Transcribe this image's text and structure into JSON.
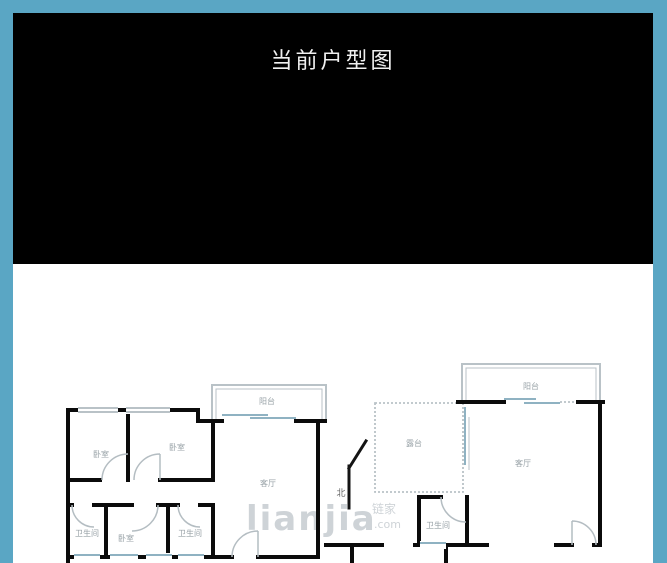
{
  "frame": {
    "border_color": "#5aa6c4",
    "header_bg": "#000000",
    "content_bg": "#ffffff"
  },
  "header": {
    "title": "当前户型图"
  },
  "floorplan": {
    "compass": {
      "north_label": "北"
    },
    "watermark": {
      "brand": "lianjia",
      "brand_cn": "链家",
      "domain": ".com"
    },
    "rooms": {
      "left_balcony": "阳台",
      "left_bedroom_main": "卧室",
      "left_bedroom_second": "卧室",
      "left_living": "客厅",
      "left_bath_1": "卫生间",
      "left_bedroom_small": "卧室",
      "left_bath_2": "卫生间",
      "right_balcony": "阳台",
      "right_terrace": "露台",
      "right_living": "客厅",
      "right_bath": "卫生间"
    },
    "colors": {
      "wall": "#0b0b0b",
      "thin_line": "#b9c2c7",
      "glass_line": "#8fb2c2",
      "label": "#98a2a7",
      "watermark": "#c9cfd3"
    }
  }
}
